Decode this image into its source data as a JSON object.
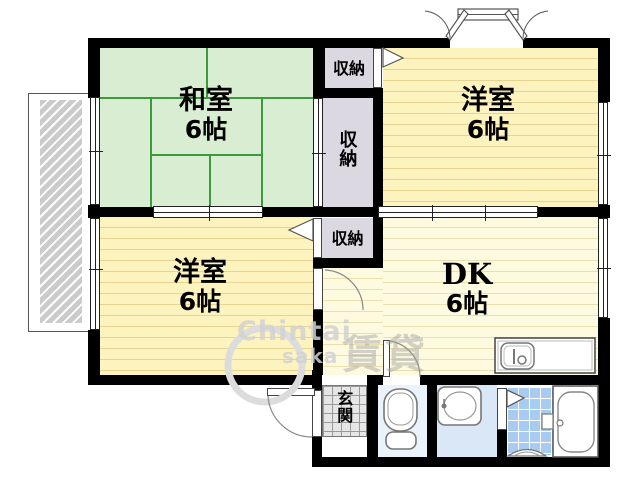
{
  "plan_title": "apartment-floor-plan",
  "rooms": {
    "washitsu": {
      "label": "和室",
      "size": "6帖"
    },
    "youshitsu_top_right": {
      "label": "洋室",
      "size": "6帖"
    },
    "youshitsu_bottom_left": {
      "label": "洋室",
      "size": "6帖"
    },
    "dk": {
      "label": "DK",
      "size": "6帖"
    }
  },
  "closets": {
    "top": {
      "label": "収納"
    },
    "middle": {
      "label": "収納"
    },
    "bottom": {
      "label": "収納"
    }
  },
  "entrance": {
    "label": "玄関"
  },
  "watermark": {
    "text1": "Chintai",
    "text2": "saka",
    "brand": "賃貸"
  },
  "colors": {
    "wall": "#000000",
    "tatami_fill": "#d9edd2",
    "tatami_line": "#3a9a3c",
    "western_fill": "#fdf3be",
    "western_stripe": "#e8d392",
    "dk_fill": "#fefae0",
    "dk_stripe": "#eadfae",
    "closet_fill": "#dcd8e1",
    "genkan_fill": "#e6e6e6",
    "toilet_floor": "#eaf2fb",
    "wash_floor": "#d9e7f6",
    "bath_tile": "#a8cbf1",
    "balcony_hatch": "#cbcbcb",
    "watermark_gray": "#d2d2d2"
  }
}
